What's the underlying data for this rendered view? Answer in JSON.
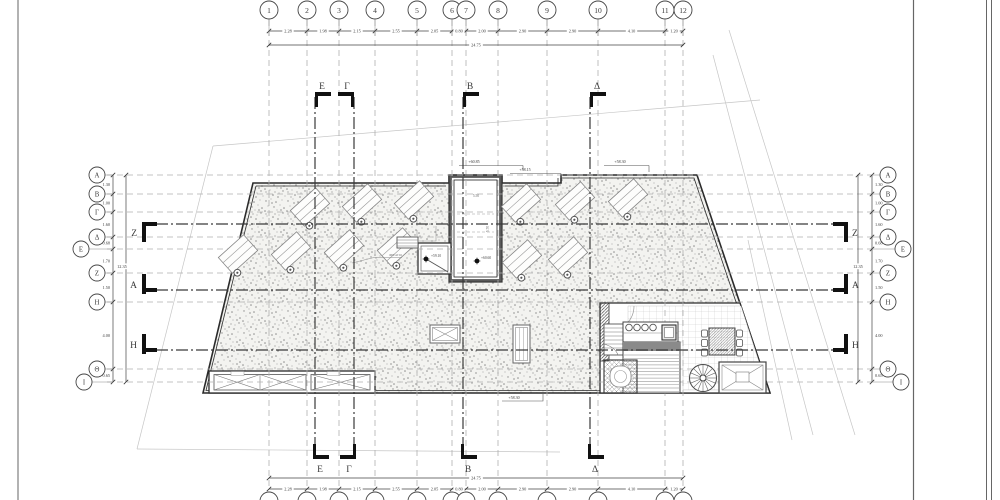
{
  "sheet": {
    "line_color": "#2b2b2b",
    "grid_dash_color": "#b0b0b0",
    "boundary_color": "#c6c6c6",
    "stipple_dot_color": "#8d8d8d"
  },
  "grid": {
    "column_total": "24.75",
    "columns": [
      {
        "label": "1",
        "x": 269
      },
      {
        "label": "2",
        "x": 307
      },
      {
        "label": "3",
        "x": 339
      },
      {
        "label": "4",
        "x": 375
      },
      {
        "label": "5",
        "x": 417
      },
      {
        "label": "6",
        "x": 452
      },
      {
        "label": "7",
        "x": 466
      },
      {
        "label": "8",
        "x": 498
      },
      {
        "label": "9",
        "x": 547
      },
      {
        "label": "10",
        "x": 598
      },
      {
        "label": "11",
        "x": 665
      },
      {
        "label": "12",
        "x": 683
      }
    ],
    "column_dims": [
      "2.28",
      "1.98",
      "2.15",
      "2.55",
      "2.05",
      "0.80",
      "2.00",
      "2.90",
      "2.90",
      "4.10",
      "1.20"
    ],
    "row_total": "12.35",
    "rows": [
      {
        "label": "Α",
        "y": 175,
        "cxl": 97,
        "cxr": 888
      },
      {
        "label": "Β",
        "y": 194,
        "cxl": 97,
        "cxr": 888
      },
      {
        "label": "Γ",
        "y": 212,
        "cxl": 97,
        "cxr": 888
      },
      {
        "label": "Δ",
        "y": 237,
        "cxl": 97,
        "cxr": 888
      },
      {
        "label": "Ε",
        "y": 249,
        "cxl": 81,
        "cxr": 903
      },
      {
        "label": "Ζ",
        "y": 273,
        "cxl": 97,
        "cxr": 888
      },
      {
        "label": "Η",
        "y": 302,
        "cxl": 97,
        "cxr": 888
      },
      {
        "label": "Θ",
        "y": 369,
        "cxl": 97,
        "cxr": 888
      },
      {
        "label": "Ι",
        "y": 382,
        "cxl": 84,
        "cxr": 901
      }
    ],
    "row_dims": [
      "1.30",
      "1.00",
      "1.60",
      "0.68",
      "1.70",
      "1.50",
      "4.00",
      "0.65"
    ]
  },
  "sections": {
    "vertical": [
      {
        "label": "Ε",
        "x": 315,
        "dir": 1
      },
      {
        "label": "Γ",
        "x": 354,
        "dir": -1
      },
      {
        "label": "Β",
        "x": 463,
        "dir": 1
      },
      {
        "label": "Δ",
        "x": 590,
        "dir": 1
      }
    ],
    "horizontal": [
      {
        "label": "Ζ",
        "y": 224,
        "nub": "top"
      },
      {
        "label": "Α",
        "y": 290,
        "nub": "bottom"
      },
      {
        "label": "Η",
        "y": 350,
        "nub": "bottom"
      }
    ]
  },
  "elevations": [
    {
      "text": "+60.85",
      "x": 474,
      "y": 163
    },
    {
      "text": "+58.15",
      "x": 525,
      "y": 171
    },
    {
      "text": "+58.30",
      "x": 620,
      "y": 163
    },
    {
      "text": "+58.30",
      "x": 514,
      "y": 399
    },
    {
      "text": "+59.10",
      "x": 431,
      "y": 257
    },
    {
      "text": "+60.60",
      "x": 481,
      "y": 259
    }
  ],
  "plan_labels": {
    "shaft_label": "ΦΡΕΑΤΙΟ",
    "bulkhead_dim_w": "5.50",
    "bulkhead_dim_h": "5.70"
  }
}
